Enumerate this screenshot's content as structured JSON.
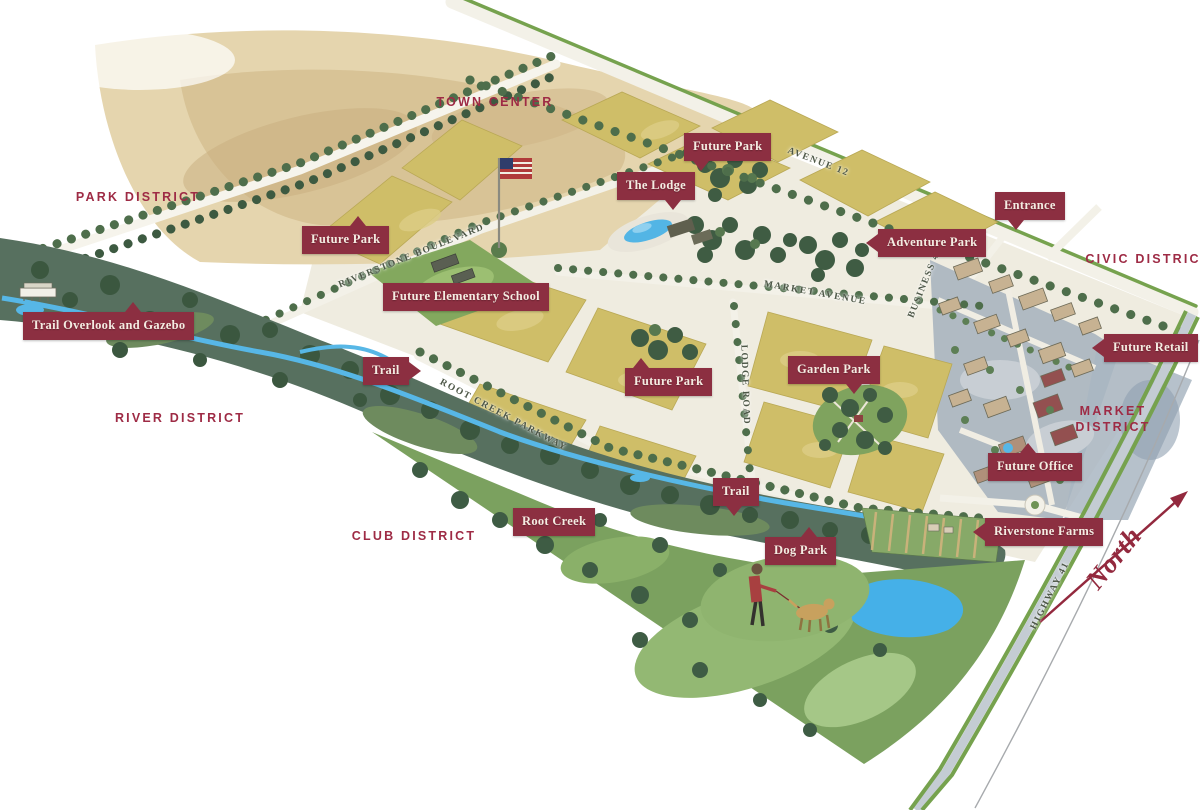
{
  "map": {
    "districts": [
      "TOWN CENTER",
      "PARK DISTRICT",
      "CIVIC DISTRICT",
      "RIVER DISTRICT",
      "MARKET DISTRICT",
      "CLUB DISTRICT"
    ],
    "markers": [
      "Future Park",
      "The Lodge",
      "Entrance",
      "Adventure Park",
      "Future Park",
      "Future Elementary School",
      "Trail Overlook and Gazebo",
      "Future Retail",
      "Trail",
      "Future Park",
      "Garden Park",
      "Future Office",
      "Trail",
      "Root Creek",
      "Riverstone Farms",
      "Dog Park"
    ],
    "roads": [
      "AVENUE 12",
      "RIVERSTONE BOULEVARD",
      "MARKET AVENUE",
      "BUSINESS 41",
      "LODGE ROAD",
      "ROOT CREEK PARKWAY",
      "HIGHWAY 41"
    ],
    "compass": "North",
    "colors": {
      "badge": "#8C2F41",
      "district_label": "#9E2B45",
      "road_label": "#4D5747",
      "north_arrow": "#93293E"
    }
  }
}
